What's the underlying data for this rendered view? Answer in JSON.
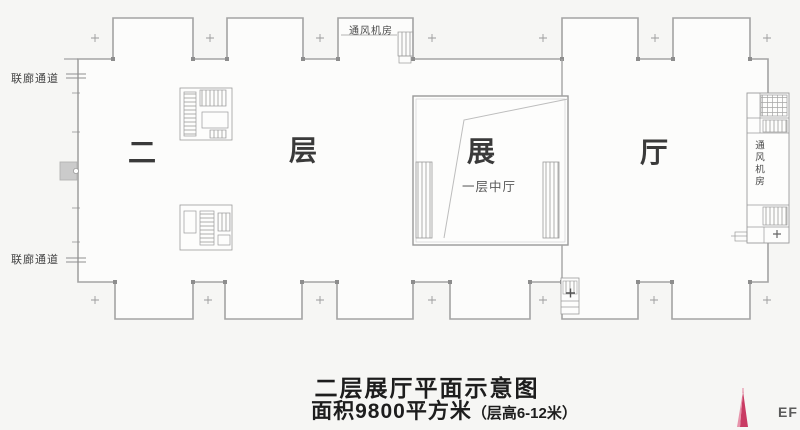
{
  "plan": {
    "labels": {
      "corridor_top": "联廊通道",
      "corridor_bottom": "联廊通道",
      "vent_room_top": "通风机房",
      "vent_room_right": "通风机房",
      "atrium_note": "一层中厅"
    },
    "hall_chars": [
      "二",
      "层",
      "展",
      "厅"
    ],
    "title_line1": "二层展厅平面示意图",
    "area_text": "面积9800平方米",
    "height_note": "（层高6-12米）",
    "watermark_text": "EF"
  },
  "colors": {
    "wall_gray": "#a3a3a3",
    "detail_gray": "#999999",
    "text_dark": "#1d1d1d",
    "logo_pink": "#c93b63",
    "logo_pink_light": "#e794ab",
    "background": "#f6f6f4"
  }
}
